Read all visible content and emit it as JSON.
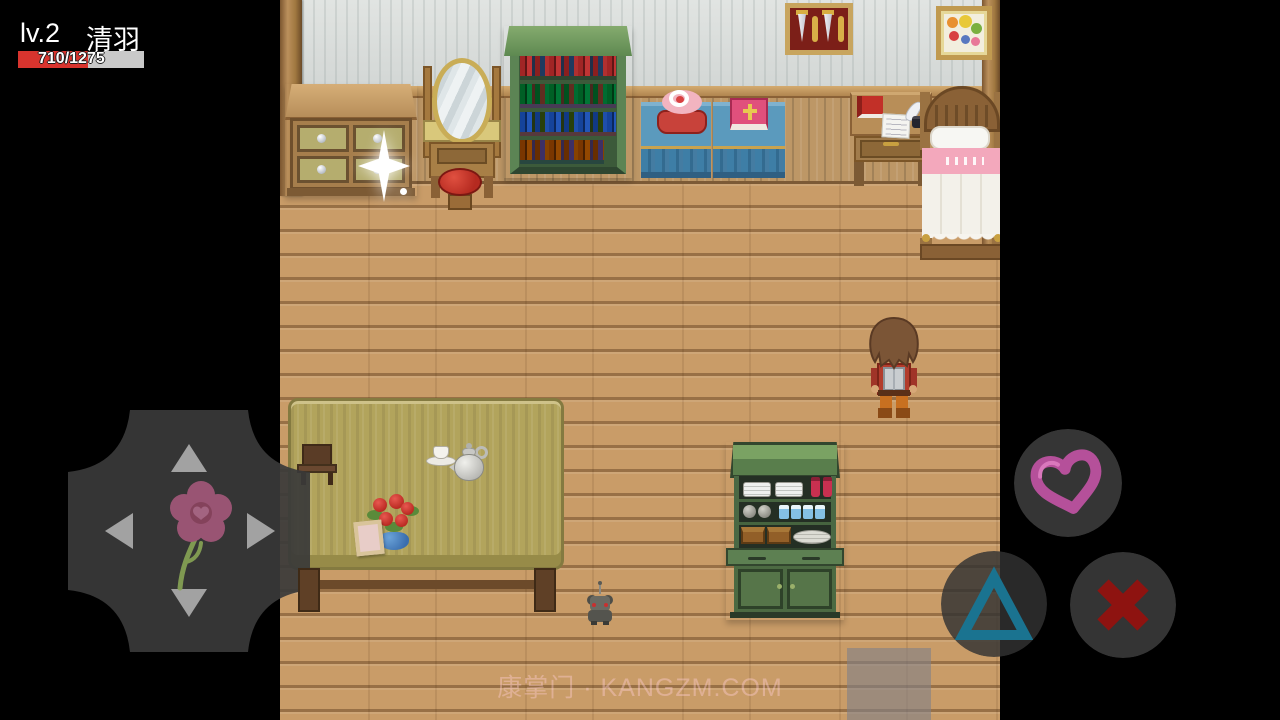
{
  "hud": {
    "level_label": "lv.2",
    "player_name": "清羽",
    "hp_text": "710/1275",
    "hp_current": 710,
    "hp_max": 1275,
    "hp_percent": 55.7,
    "hp_fill_color": "#d8342e",
    "hp_track_color": "#c9c9c9"
  },
  "controls": {
    "dpad": {
      "arrows": [
        "up",
        "left",
        "right",
        "down"
      ],
      "center_icon": "flower-icon",
      "base_color": "rgba(58,58,58,0.92)",
      "arrow_color": "#a2a2a2",
      "flower_petal_color": "#a4587a",
      "flower_stem_color": "#88a455"
    },
    "buttons": [
      {
        "id": "heart",
        "icon": "heart-icon",
        "glyph_color": "#b5509a"
      },
      {
        "id": "triangle",
        "icon": "triangle-icon",
        "glyph_color": "#1a7390"
      },
      {
        "id": "cross",
        "icon": "x-icon",
        "glyph_color": "#8e1310"
      }
    ]
  },
  "watermark": {
    "text": "康掌门 · KANGZM.COM"
  },
  "scene": {
    "description": "pixel-art bedroom interior, top-down RPG view",
    "objects": [
      "dresser-with-sparkle",
      "vanity-mirror",
      "red-stool",
      "green-bookshelf",
      "blue-cloth-table-with-cake",
      "blue-cloth-table-with-bible",
      "dagger-display-frame",
      "fruit-picture-frame",
      "writing-desk-with-book-paper-quill",
      "bed-with-pink-blanket",
      "player-character-facing-up",
      "large-dining-table",
      "small-chair",
      "tea-set",
      "flower-vase",
      "photo-frame",
      "gray-mouse",
      "green-kitchen-cabinet"
    ]
  }
}
